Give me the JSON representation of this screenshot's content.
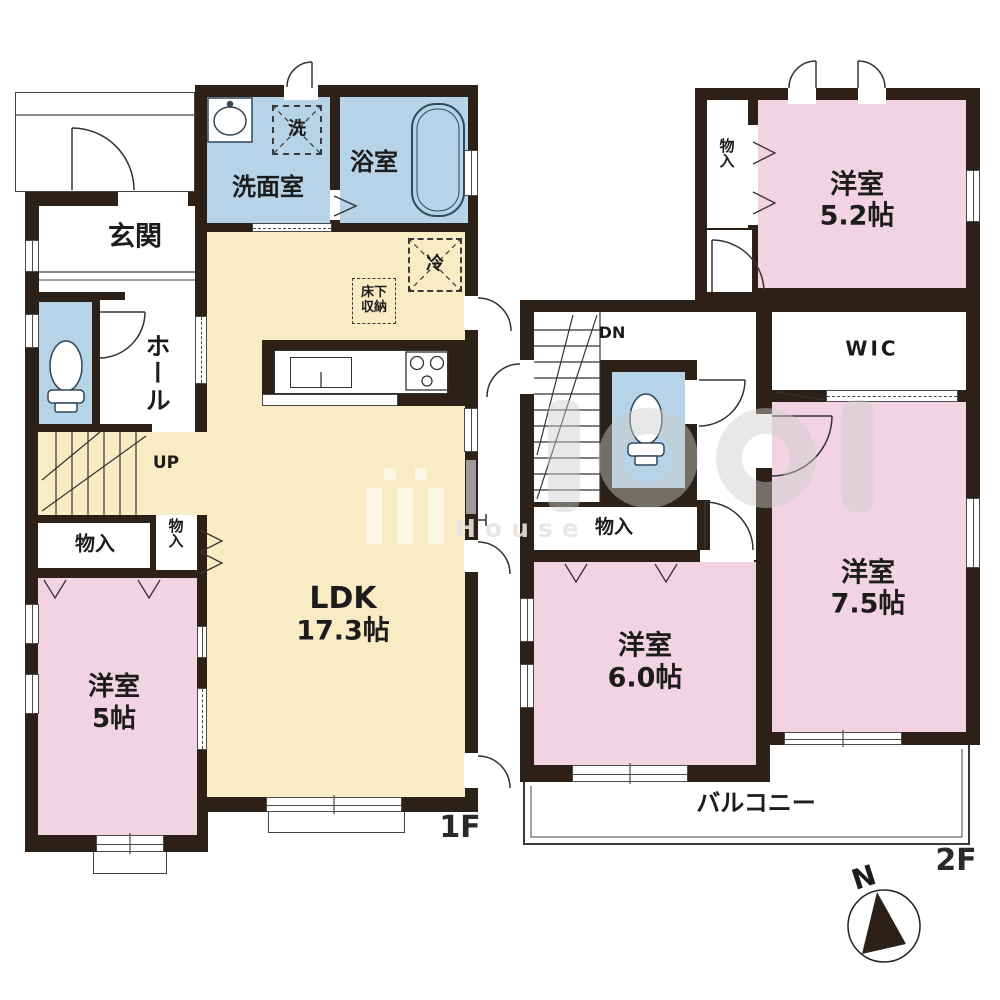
{
  "colors": {
    "wall": "#2d2117",
    "cream": "#f9ecc5",
    "blue": "#b6d3e7",
    "pink": "#f1d3e1",
    "white": "#ffffff"
  },
  "f1": {
    "floor_label": "1F",
    "genkan": "玄関",
    "hall": "ホール",
    "washroom": "洗面室",
    "bathroom": "浴室",
    "washer": "洗",
    "fridge": "冷",
    "floor_storage_line1": "床下",
    "floor_storage_line2": "収納",
    "ldk": "LDK",
    "ldk_size": "17.3帖",
    "up": "UP",
    "closet_wide": "物入",
    "closet_narrow": "物入",
    "bedroom": "洋室",
    "bedroom_size": "5帖"
  },
  "f2": {
    "floor_label": "2F",
    "closet_top": "物入",
    "bedroom52": "洋室",
    "bedroom52_size": "5.2帖",
    "dn": "DN",
    "wic": "WIC",
    "closet_mid": "物入",
    "bedroom75": "洋室",
    "bedroom75_size": "7.5帖",
    "bedroom60": "洋室",
    "bedroom60_size": "6.0帖",
    "balcony": "バルコニー"
  },
  "compass": {
    "north": "N"
  },
  "watermark": {
    "text": "House"
  }
}
